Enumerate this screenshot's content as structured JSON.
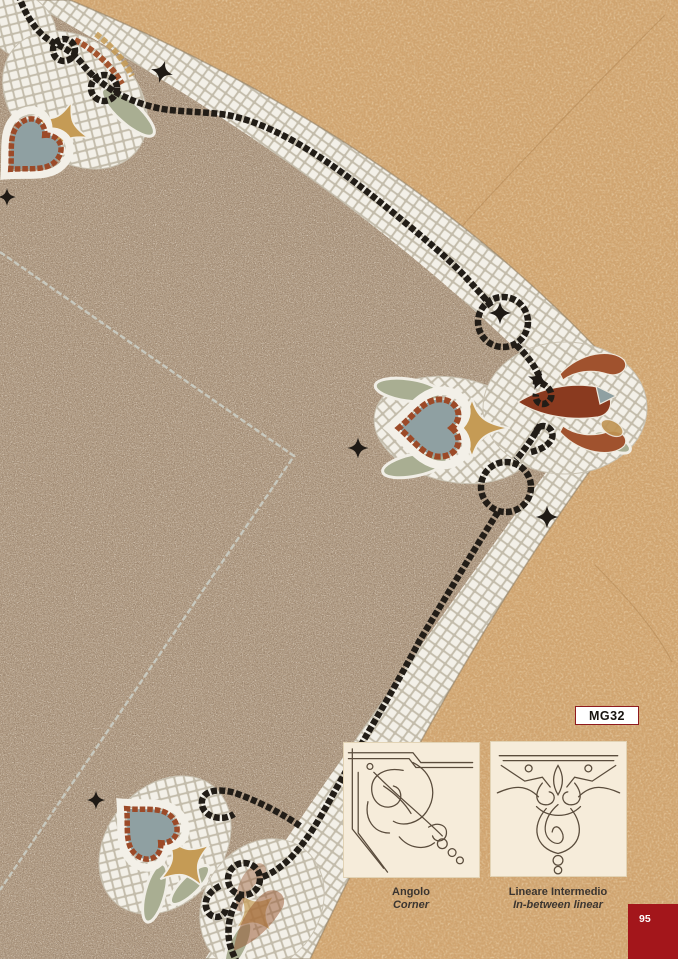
{
  "product": {
    "code": "MG32"
  },
  "thumbnails": [
    {
      "title": "Angolo",
      "subtitle": "Corner"
    },
    {
      "title": "Lineare Intermedio",
      "subtitle": "In-between linear"
    }
  ],
  "page": {
    "number": "95"
  },
  "colors": {
    "accent_red": "#a3161b",
    "badge_border_red": "#8e1a1e",
    "cork_background": "#d1a46f",
    "terrazzo_field": "#b7a28a",
    "white_tesserae": "#f3f0e8",
    "black_tesserae": "#221d17",
    "rust": "#9c4a28",
    "golden_tan": "#c59b55",
    "sage_green": "#a9ae92",
    "grey_blue": "#8fa0a2",
    "thumbnail_cream": "#f6ecda",
    "caption_ink": "#3b3530"
  }
}
